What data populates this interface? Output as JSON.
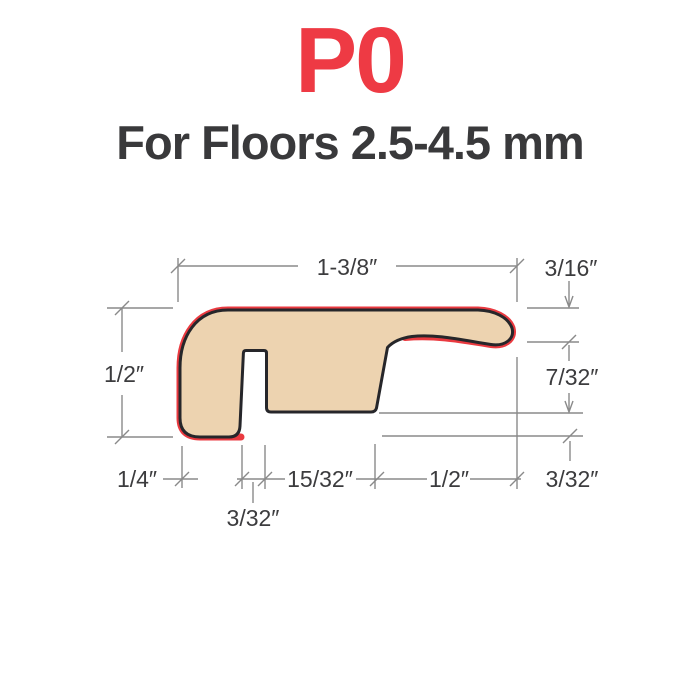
{
  "title": "P0",
  "subtitle": "For Floors 2.5-4.5 mm",
  "colors": {
    "accent_red": "#ee3a44",
    "profile_fill": "#edd3b0",
    "profile_outline": "#26262a",
    "dimension_gray": "#8a8a8a",
    "text_dark": "#39393b"
  },
  "diagram": {
    "description": "end-molding-profile-cross-section",
    "dims": {
      "top_width": "1-3/8″",
      "nose_thickness": "3/16″",
      "left_height": "1/2″",
      "underside_gap": "7/32″",
      "base_left": "1/4″",
      "base_mid": "15/32″",
      "nose_overhang": "1/2″",
      "bottom_step": "3/32″",
      "slot_width": "3/32″"
    }
  }
}
